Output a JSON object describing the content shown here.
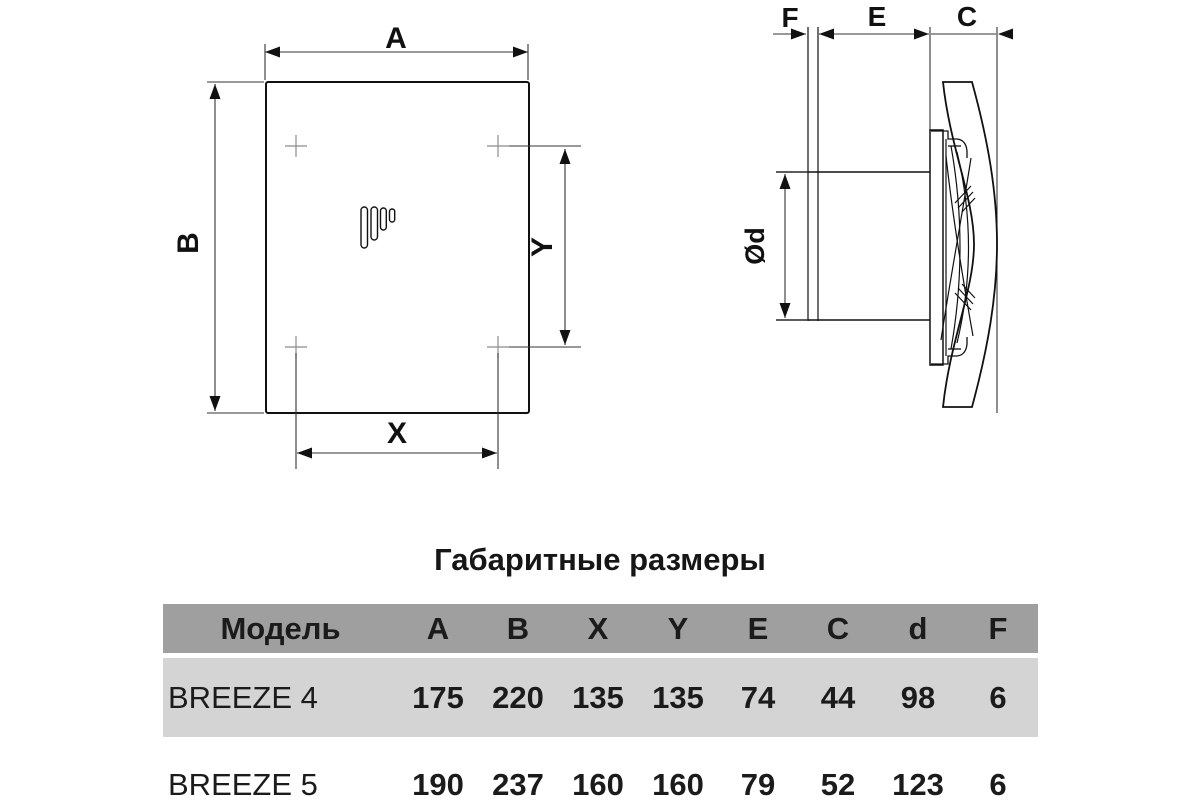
{
  "title": "Габаритные размеры",
  "drawing": {
    "front_view": {
      "width_label": "A",
      "height_label": "B",
      "hole_spacing_x_label": "X",
      "hole_spacing_y_label": "Y"
    },
    "side_view": {
      "flange_label": "F",
      "duct_length_label": "E",
      "cover_depth_label": "C",
      "duct_diameter_label": "Ød"
    }
  },
  "table": {
    "columns": [
      "Модель",
      "A",
      "B",
      "X",
      "Y",
      "E",
      "C",
      "d",
      "F"
    ],
    "rows": [
      {
        "model": "BREEZE 4",
        "values": [
          "175",
          "220",
          "135",
          "135",
          "74",
          "44",
          "98",
          "6"
        ]
      },
      {
        "model": "BREEZE 5",
        "values": [
          "190",
          "237",
          "160",
          "160",
          "79",
          "52",
          "123",
          "6"
        ]
      }
    ]
  },
  "colors": {
    "header_bg": "#9f9f9f",
    "row_alt_bg": "#d4d4d4",
    "line": "#111111"
  }
}
